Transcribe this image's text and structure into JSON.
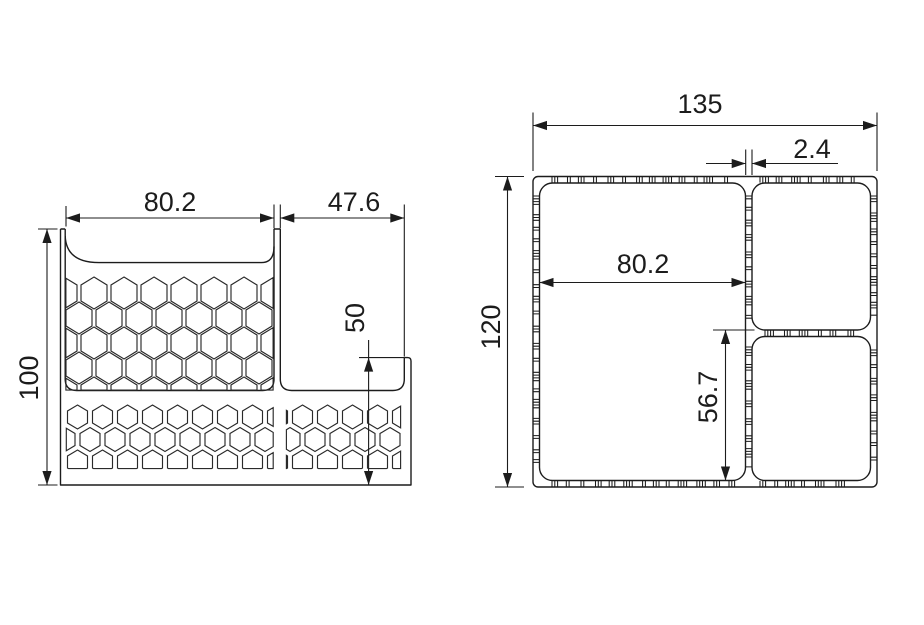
{
  "drawing": {
    "front_view": {
      "dims": {
        "opening_width": "80.2",
        "right_opening_width": "47.6",
        "overall_height": "100",
        "right_wall_height": "50"
      }
    },
    "top_view": {
      "dims": {
        "overall_width": "135",
        "wall_thickness": "2.4",
        "left_compartment_width": "80.2",
        "overall_depth": "120",
        "rear_compartment_depth": "56.7"
      }
    }
  }
}
